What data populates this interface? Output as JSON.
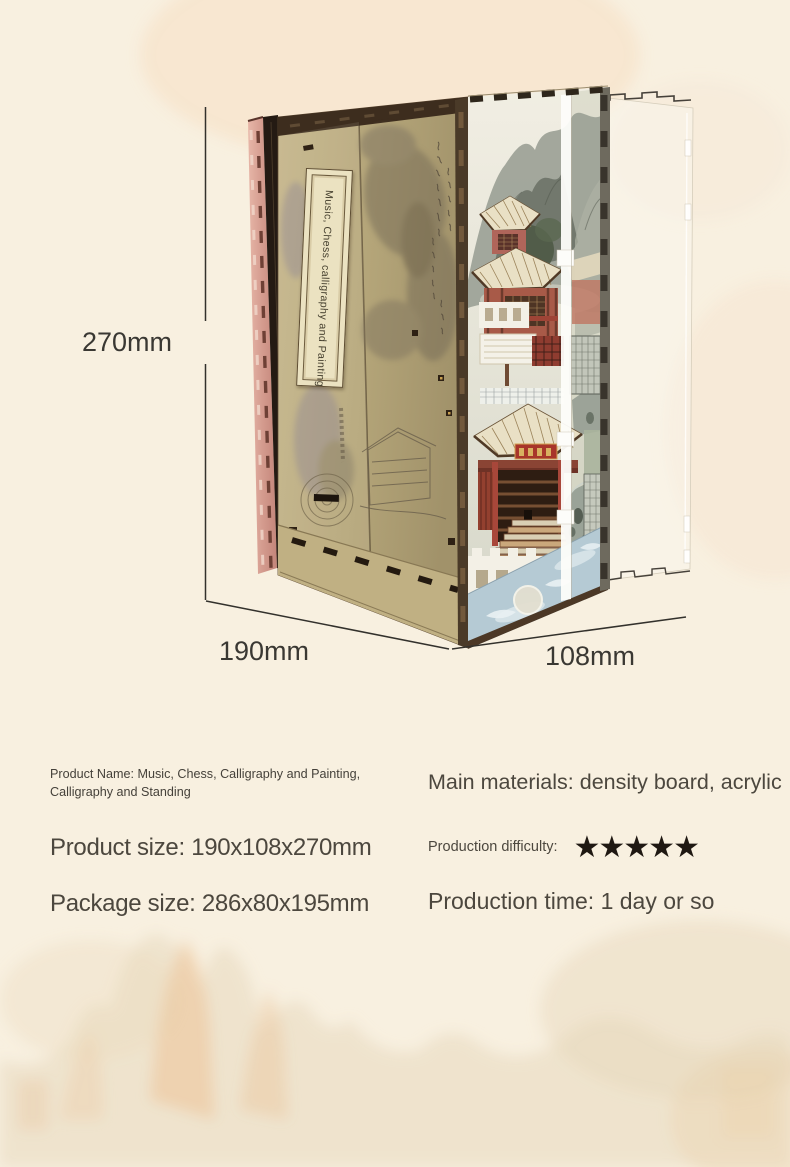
{
  "annotations": {
    "height": "270mm",
    "depth": "190mm",
    "width": "108mm"
  },
  "model": {
    "spine_label": "Music, Chess, calligraphy and Painting"
  },
  "specs": {
    "product_name": "Product Name: Music, Chess, Calligraphy and Painting, Calligraphy and Standing",
    "main_materials": "Main materials: density board, acrylic",
    "product_size": "Product size: 190x108x270mm",
    "difficulty_label": "Production difficulty:",
    "difficulty_stars": "★★★★★",
    "package_size": "Package size: 286x80x195mm",
    "production_time": "Production time: 1 day or so"
  },
  "colors": {
    "background": "#f8f0e0",
    "text": "#4c473e",
    "stars": "#1f1812",
    "bookend_pink": "#d49b8e",
    "spine_tan": "#b3a478",
    "water_blue": "#b5cad4",
    "dimension_line": "#33312c"
  }
}
